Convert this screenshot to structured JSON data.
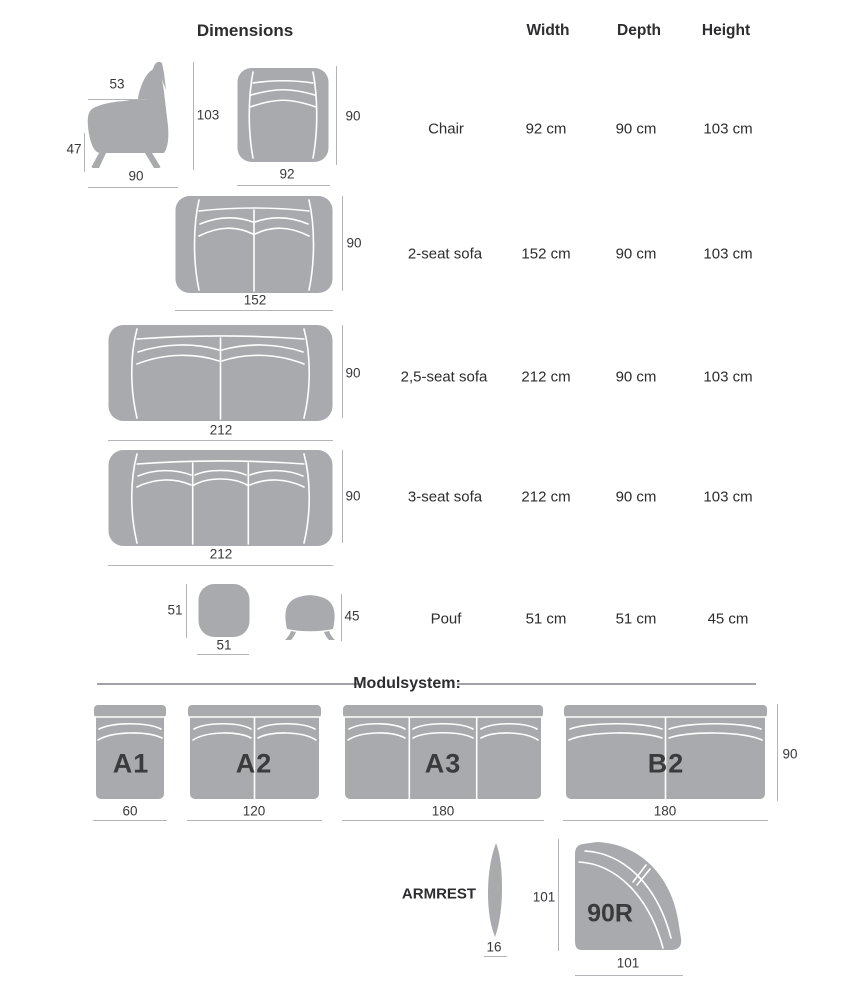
{
  "title": "Dimensions",
  "table": {
    "columns": [
      "Width",
      "Depth",
      "Height"
    ],
    "rows": [
      {
        "name": "Chair",
        "width": "92 cm",
        "depth": "90 cm",
        "height": "103 cm"
      },
      {
        "name": "2-seat sofa",
        "width": "152 cm",
        "depth": "90 cm",
        "height": "103 cm"
      },
      {
        "name": "2,5-seat sofa",
        "width": "212 cm",
        "depth": "90 cm",
        "height": "103 cm"
      },
      {
        "name": "3-seat sofa",
        "width": "212 cm",
        "depth": "90 cm",
        "height": "103 cm"
      },
      {
        "name": "Pouf",
        "width": "51 cm",
        "depth": "51 cm",
        "height": "45 cm"
      }
    ]
  },
  "diagrams": {
    "chair_side": {
      "top": "53",
      "height": "103",
      "seat_height": "47",
      "depth": "90"
    },
    "chair_front": {
      "depth": "90",
      "width": "92"
    },
    "sofa_2seat": {
      "depth": "90",
      "width": "152"
    },
    "sofa_25seat": {
      "depth": "90",
      "width": "212"
    },
    "sofa_3seat": {
      "depth": "90",
      "width": "212"
    },
    "pouf_top": {
      "depth": "51",
      "width": "51"
    },
    "pouf_side": {
      "height": "45"
    }
  },
  "modulsystem": {
    "heading": "Modulsystem:",
    "depth": "90",
    "modules": [
      {
        "label": "A1",
        "width": "60"
      },
      {
        "label": "A2",
        "width": "120"
      },
      {
        "label": "A3",
        "width": "180"
      },
      {
        "label": "B2",
        "width": "180"
      }
    ]
  },
  "extras": {
    "armrest": {
      "label": "ARMREST",
      "width": "16"
    },
    "corner": {
      "label": "90R",
      "depth": "101",
      "width": "101"
    }
  },
  "colors": {
    "furniture_fill": "#a8aaad",
    "seam": "#ffffff",
    "dimension_line": "#b2b4b7",
    "text": "#2d2c2e"
  }
}
